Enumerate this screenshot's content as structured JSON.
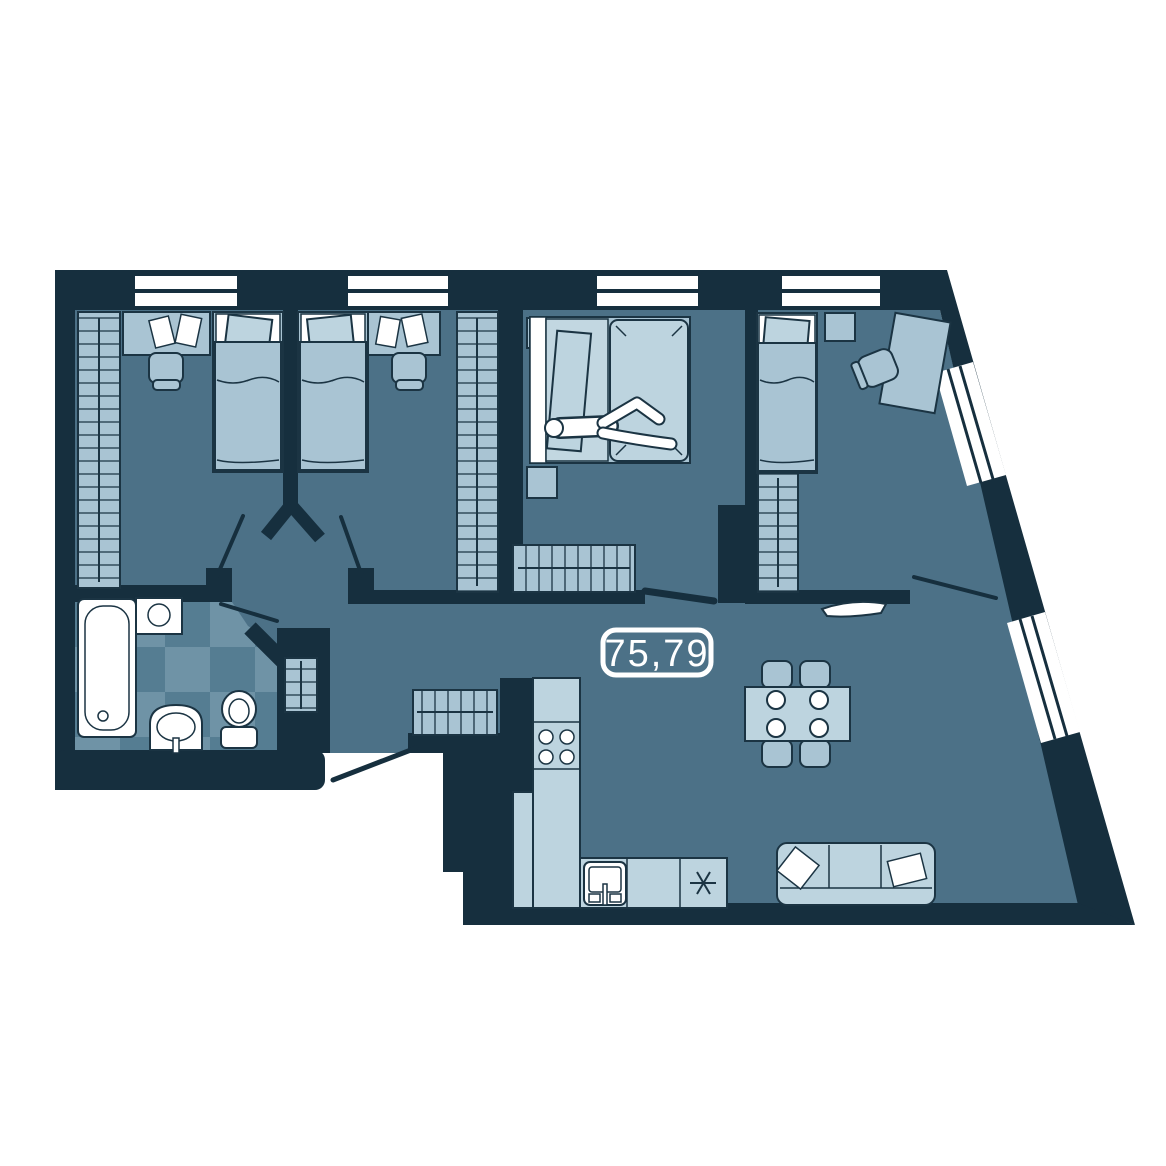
{
  "floorplan": {
    "area_label": "75,79",
    "colors": {
      "wall": "#162f3e",
      "floor": "#4c7187",
      "furniture": "#a9c4d3",
      "furniture_light": "#bdd4df",
      "white": "#ffffff",
      "outline": "#1b3443",
      "tile_a": "#557d92",
      "tile_b": "#6f93a6"
    }
  }
}
